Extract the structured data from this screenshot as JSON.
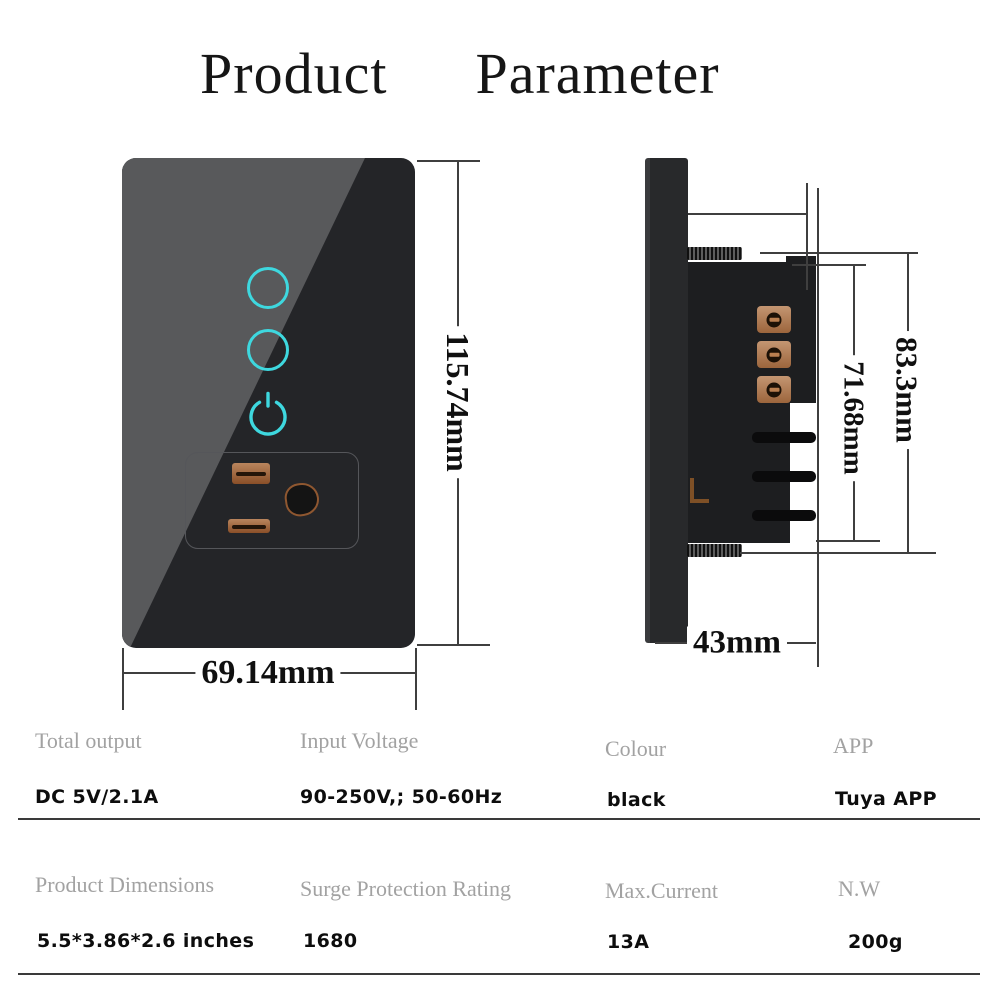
{
  "title": {
    "word1": "Product",
    "word2": "Parameter"
  },
  "colors": {
    "accent_cyan": "#3ED8DF",
    "copper": "#B9825E",
    "panel_light": "#58595B",
    "panel_dark": "#242528"
  },
  "front_view": {
    "height_label": "115.74mm",
    "width_label": "69.14mm",
    "touch_buttons": [
      "circle",
      "circle",
      "power-symbol"
    ]
  },
  "side_view": {
    "overall_height_label": "83.3mm",
    "body_height_label": "71.68mm",
    "depth_label": "43mm"
  },
  "specs": {
    "rows": [
      {
        "cells": [
          {
            "label": "Total output",
            "value": "DC 5V/2.1A"
          },
          {
            "label": "Input Voltage",
            "value": "90-250V,; 50-60Hz"
          },
          {
            "label": "Colour",
            "value": "black"
          },
          {
            "label": "APP",
            "value": "Tuya APP"
          }
        ]
      },
      {
        "cells": [
          {
            "label": "Product Dimensions",
            "value": "5.5*3.86*2.6 inches"
          },
          {
            "label": "Surge Protection Rating",
            "value": "1680"
          },
          {
            "label": "Max.Current",
            "value": "13A"
          },
          {
            "label": "N.W",
            "value": "200g"
          }
        ]
      }
    ]
  }
}
